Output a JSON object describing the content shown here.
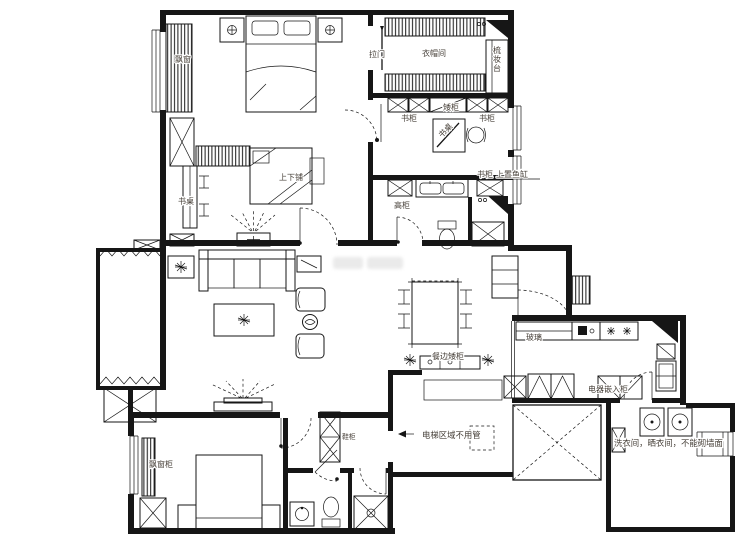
{
  "canvas": {
    "width": 740,
    "height": 540
  },
  "colors": {
    "background": "#ffffff",
    "line": "#161616",
    "label": "#474039",
    "watermark": "#dcdcdc"
  },
  "labels": [
    {
      "id": "bay-window-top",
      "text": "飘窗"
    },
    {
      "id": "sliding-door",
      "text": "拉门"
    },
    {
      "id": "walk-in-closet",
      "text": "衣帽间"
    },
    {
      "id": "dressing-table",
      "text": "梳妆台"
    },
    {
      "id": "bookcase-left",
      "text": "书柜"
    },
    {
      "id": "low-cabinet",
      "text": "矮柜"
    },
    {
      "id": "desk-study",
      "text": "书桌"
    },
    {
      "id": "bookcase-right",
      "text": "书柜"
    },
    {
      "id": "bookcase-small",
      "text": "书柜"
    },
    {
      "id": "fish-tank-note",
      "text": "上置鱼缸"
    },
    {
      "id": "tall-cabinet",
      "text": "高柜"
    },
    {
      "id": "desk-kids",
      "text": "书桌"
    },
    {
      "id": "bunk-bed",
      "text": "上下铺"
    },
    {
      "id": "glass-partition",
      "text": "玻璃"
    },
    {
      "id": "sideboard",
      "text": "餐边矮柜"
    },
    {
      "id": "appliance-cabinet",
      "text": "电器嵌入柜"
    },
    {
      "id": "laundry-note",
      "text": "洗衣间，晒衣间，不能砌墙面"
    },
    {
      "id": "elevator-note",
      "text": "电梯区域不用管"
    },
    {
      "id": "bay-window-cabinet",
      "text": "飘窗柜"
    },
    {
      "id": "shoe-cabinet",
      "text": "鞋柜"
    }
  ]
}
